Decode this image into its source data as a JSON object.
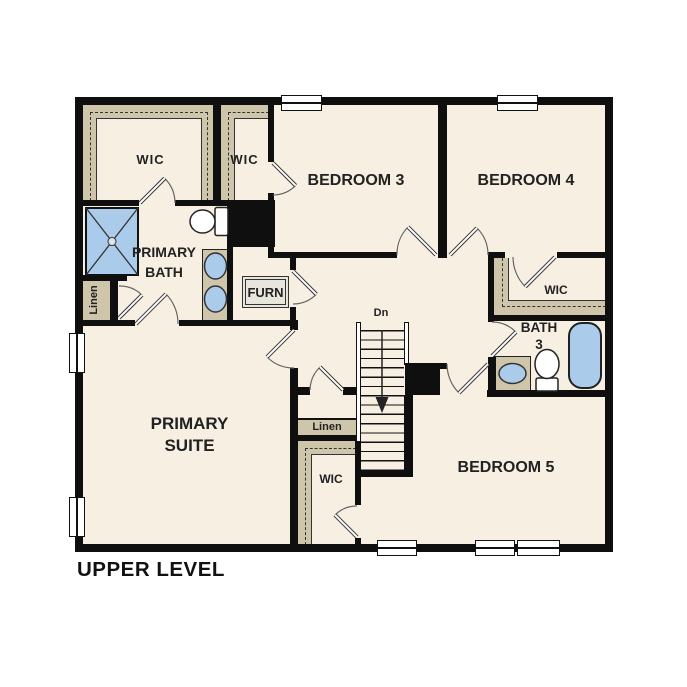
{
  "title": "UPPER LEVEL",
  "labels": {
    "plan_title": "UPPER LEVEL",
    "wic_primary": "WIC",
    "wic_bedroom3": "WIC",
    "wic_bedroom4": "WIC",
    "wic_bedroom5": "WIC",
    "bedroom3": "BEDROOM 3",
    "bedroom4": "BEDROOM 4",
    "bedroom5": "BEDROOM 5",
    "primary_bath_line1": "PRIMARY",
    "primary_bath_line2": "BATH",
    "primary_suite_line1": "PRIMARY",
    "primary_suite_line2": "SUITE",
    "bath3_line1": "BATH",
    "bath3_line2": "3",
    "linen_left": "Linen",
    "linen_center": "Linen",
    "furnace": "FURN",
    "stair_direction": "Dn"
  },
  "colors": {
    "wall": "#0f0f0f",
    "floor": "#f6efe2",
    "closet": "#cfc5ab",
    "fixture": "#abcbea",
    "text": "#222222"
  }
}
